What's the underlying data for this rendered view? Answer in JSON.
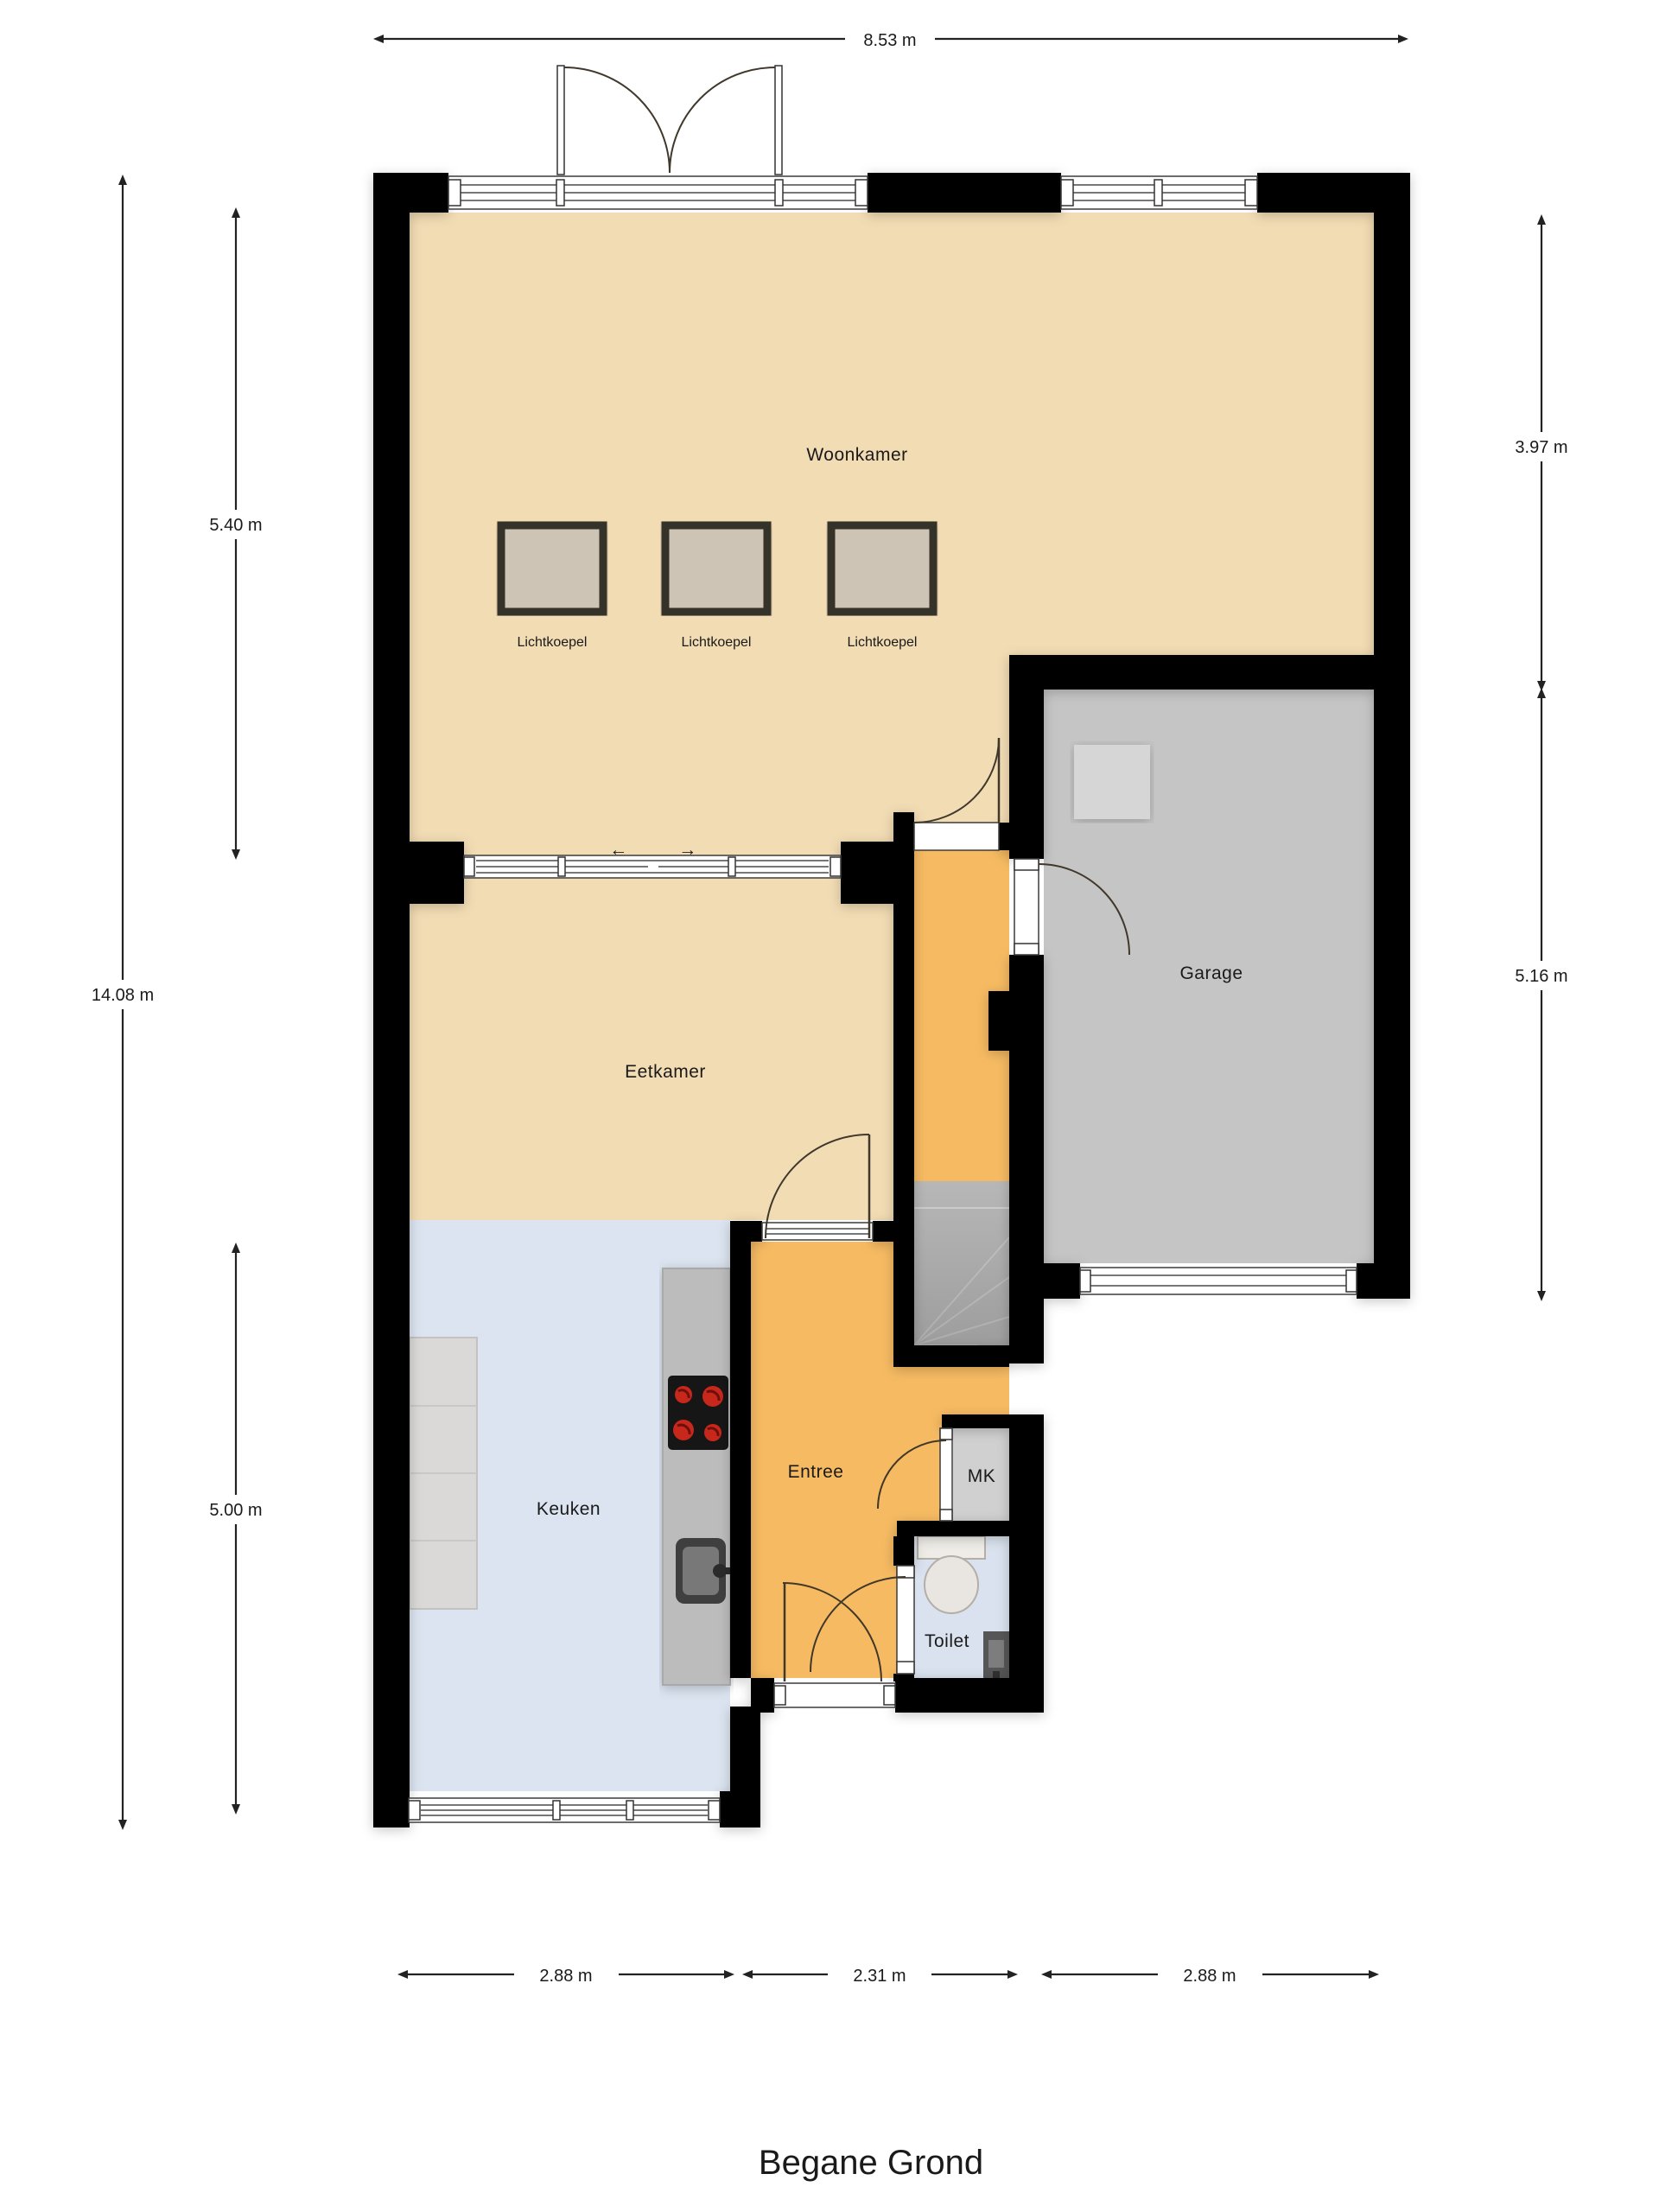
{
  "title": "Begane Grond",
  "rooms": {
    "woonkamer": "Woonkamer",
    "eetkamer": "Eetkamer",
    "keuken": "Keuken",
    "entree": "Entree",
    "mk": "MK",
    "toilet": "Toilet",
    "garage": "Garage"
  },
  "skylight": {
    "label": "Lichtkoepel",
    "count": 3
  },
  "dimensions": {
    "top_width": "8.53 m",
    "left_total_height": "14.08 m",
    "left_upper": "5.40 m",
    "left_lower": "5.00 m",
    "right_upper": "3.97 m",
    "right_lower": "5.16 m",
    "bottom_kitchen": "2.88 m",
    "bottom_entree": "2.31 m",
    "bottom_garage": "2.88 m"
  },
  "icons": {
    "slide_left": "←",
    "slide_right": "→"
  },
  "colors": {
    "floor_living": "#f2dcb4",
    "floor_hall": "#f6ba62",
    "floor_kitchen": "#dbe4f0",
    "floor_toilet": "#d9e2ee",
    "floor_garage": "#c5c5c6",
    "floor_mk": "#d0d0d0",
    "floor_stairs": "#b7b7b7",
    "wall": "#000000",
    "skylight_fill": "#cdc4b6",
    "counter": "#bcbcbc",
    "island": "#dad9d7"
  }
}
